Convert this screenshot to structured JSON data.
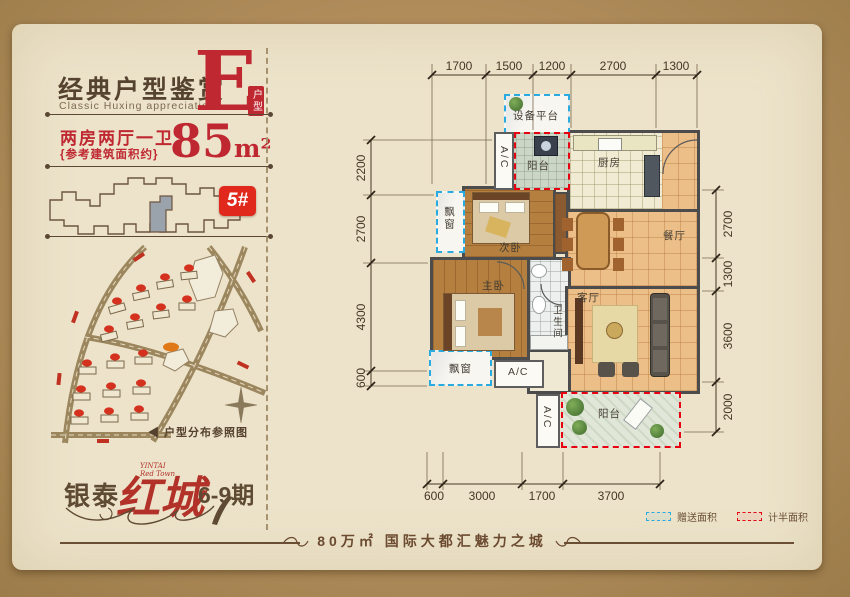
{
  "card": {
    "header": {
      "title": "经典户型鉴赏",
      "subtitle": "Classic Huxing appreciation",
      "type_letter": "E",
      "type_tag": "户型",
      "layout": "两房两厅一卫",
      "area_note": "{参考建筑面积约}",
      "area_value": "85",
      "area_unit": "m²",
      "building_badge": "5#"
    },
    "map": {
      "caption_arrow": "◀",
      "caption": "户型分布参照图"
    },
    "logo": {
      "brand": "银泰",
      "name_en1": "YINTAI",
      "name_en2": "Red Town",
      "name": "红城",
      "phase": "6-9期"
    },
    "tagline": "80万㎡ 国际大都汇魅力之城"
  },
  "floorplan": {
    "rooms": {
      "equipment_platform": "设备平台",
      "balcony_top": "阳台",
      "kitchen": "厨房",
      "bedroom2": "次卧",
      "dining": "餐厅",
      "master": "主卧",
      "bath": "卫生间",
      "living": "客厅",
      "bay_window": "飘窗",
      "balcony_bottom": "阳台",
      "ac": "A/C"
    },
    "dims": {
      "top": [
        "1700",
        "1500",
        "1200",
        "2700",
        "1300"
      ],
      "left": [
        "2200",
        "2700",
        "4300",
        "600"
      ],
      "right": [
        "2700",
        "1300",
        "3600",
        "2000"
      ],
      "bottom": [
        "600",
        "3000",
        "1700",
        "3700"
      ]
    }
  },
  "legend": {
    "gift": {
      "label": "赠送面积",
      "color": "#29abe2"
    },
    "half": {
      "label": "计半面积",
      "color": "#e60012"
    }
  },
  "colors": {
    "accent_red": "#bf2731",
    "badge_red": "#e0291c",
    "dark_brown": "#5a4632",
    "wall_gray": "#4c4c4c"
  }
}
